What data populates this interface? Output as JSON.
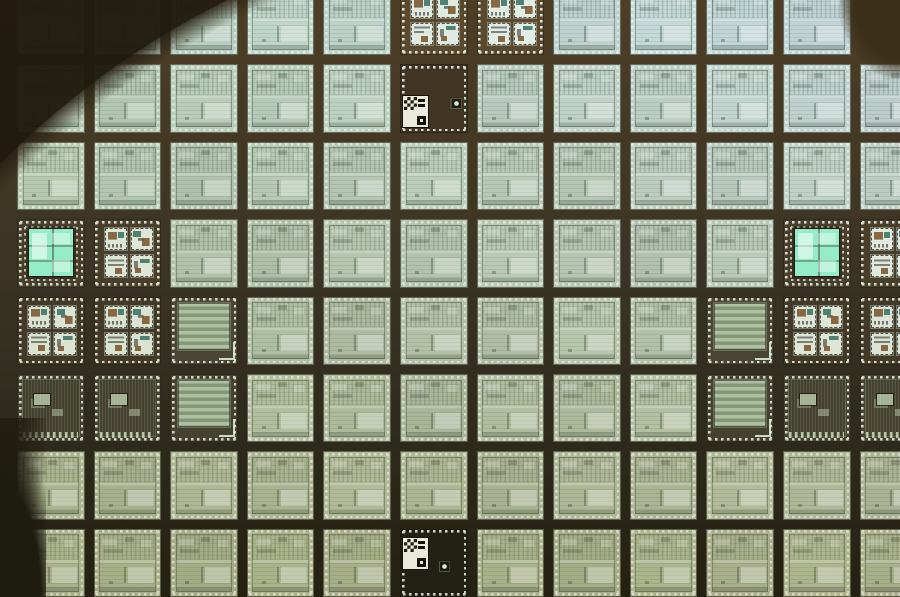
{
  "scene": {
    "description": "Macro photograph of a silicon wafer surface: a grid of pale green integrated-circuit dies separated by dark scribe-line streets lined with bright bond pads. Process-control test dies with mint-green squares sit at the left and right edges, striped capacitor test dies nearby, and two dark dies carry white checkerboard alignment marks. The color shifts from blue-green at the top right to olive yellow-green at the bottom; dark wafer-edge shadows cut across the top-left, top-right and bottom-left corners.",
    "subject": "silicon-wafer-die-grid",
    "image_type": "photograph"
  },
  "wafer": {
    "cols": 12,
    "rows": 8,
    "offset_x": 8,
    "offset_y": -22,
    "pitch_x": 76.6,
    "pitch_y": 77.4,
    "street": 9,
    "palette": {
      "die_tint_top_left": "#a9bfae",
      "die_tint_top_right": "#b6cad0",
      "die_tint_bottom_left": "#b1b98e",
      "die_tint_bottom_right": "#b4bb90",
      "street_top": "#4c3d26",
      "street_mid": "#3a3222",
      "street_bottom": "#242214",
      "pad_highlight": "#f8fcf5",
      "mint_square": "#b2efd2",
      "mark_white": "#eceadb",
      "shadow": "#2a2314"
    },
    "special_dies": [
      {
        "col": 5,
        "row": 0,
        "type": "test_quad"
      },
      {
        "col": 6,
        "row": 0,
        "type": "test_quad"
      },
      {
        "col": 11,
        "row": 0,
        "type": "empty"
      },
      {
        "col": 5,
        "row": 1,
        "type": "mark_die",
        "tag": "bl"
      },
      {
        "col": 0,
        "row": 3,
        "type": "test_big"
      },
      {
        "col": 1,
        "row": 3,
        "type": "test_quad"
      },
      {
        "col": 10,
        "row": 3,
        "type": "test_big"
      },
      {
        "col": 11,
        "row": 3,
        "type": "test_quad"
      },
      {
        "col": 0,
        "row": 4,
        "type": "test_quad"
      },
      {
        "col": 1,
        "row": 4,
        "type": "test_quad"
      },
      {
        "col": 2,
        "row": 4,
        "type": "cap_stripe"
      },
      {
        "col": 9,
        "row": 4,
        "type": "cap_stripe"
      },
      {
        "col": 10,
        "row": 4,
        "type": "test_quad"
      },
      {
        "col": 11,
        "row": 4,
        "type": "test_quad"
      },
      {
        "col": 0,
        "row": 5,
        "type": "dark_fine"
      },
      {
        "col": 1,
        "row": 5,
        "type": "dark_fine"
      },
      {
        "col": 2,
        "row": 5,
        "type": "cap_stripe"
      },
      {
        "col": 9,
        "row": 5,
        "type": "cap_stripe"
      },
      {
        "col": 10,
        "row": 5,
        "type": "dark_fine"
      },
      {
        "col": 11,
        "row": 5,
        "type": "dark_fine"
      },
      {
        "col": 5,
        "row": 7,
        "type": "mark_die",
        "tag": "tl"
      }
    ],
    "street_marks": [
      {
        "x": 452,
        "y": 99,
        "kind": "port"
      },
      {
        "x": 424,
        "y": 29,
        "kind": "dash"
      },
      {
        "x": 440,
        "y": 562,
        "kind": "port"
      }
    ],
    "edge_shadows": [
      "top-left",
      "top-right",
      "bottom-left"
    ]
  }
}
